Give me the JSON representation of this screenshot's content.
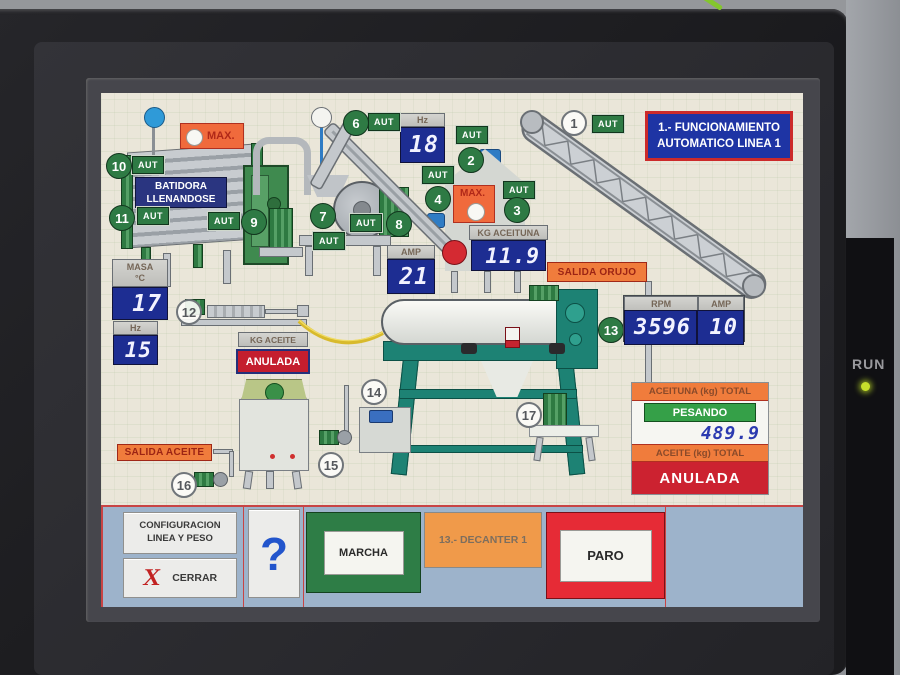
{
  "device": {
    "run_label": "RUN"
  },
  "title": {
    "line1": "1.- FUNCIONAMIENTO",
    "line2": "AUTOMATICO LINEA 1"
  },
  "aut_label": "AUT",
  "labels": {
    "max": "MAX.",
    "batidora_line1": "BATIDORA",
    "batidora_line2": "LLENANDOSE",
    "salida_orujo": "SALIDA ORUJO",
    "salida_aceite": "SALIDA ACEITE",
    "kg_aceite": "KG ACEITE",
    "kg_aceite_status": "ANULADA"
  },
  "badges": {
    "b1": "1",
    "b2": "2",
    "b3": "3",
    "b4": "4",
    "b6": "6",
    "b7": "7",
    "b8": "8",
    "b9": "9",
    "b10": "10",
    "b11": "11",
    "b12": "12",
    "b13": "13",
    "b14": "14",
    "b15": "15",
    "b16": "16",
    "b17": "17"
  },
  "displays": {
    "hz6": {
      "h": "Hz",
      "v": "18"
    },
    "amp8": {
      "h": "AMP",
      "v": "21"
    },
    "kg_aceituna": {
      "h": "KG ACEITUNA",
      "v": "11.9"
    },
    "masa": {
      "h1": "MASA",
      "h2": "°C",
      "v": "17"
    },
    "hz12": {
      "h": "Hz",
      "v": "15"
    },
    "rpm13": {
      "h": "RPM",
      "v": "3596"
    },
    "amp13": {
      "h": "AMP",
      "v": "10"
    }
  },
  "totals": {
    "aceituna_header": "ACEITUNA (kg) TOTAL",
    "status": "PESANDO",
    "value": "489.9",
    "aceite_header": "ACEITE (kg) TOTAL",
    "aceite_status": "ANULADA"
  },
  "footer": {
    "config_line1": "CONFIGURACION",
    "config_line2": "LINEA Y PESO",
    "close_x": "X",
    "close_label": "CERRAR",
    "help": "?",
    "marcha": "MARCHA",
    "decanter": "13.- DECANTER 1",
    "paro": "PARO"
  },
  "colors": {
    "accent_green": "#2e7a44",
    "display_blue": "#1d2d92",
    "alarm_red": "#cc2230",
    "warn_orange": "#f07c3c",
    "title_blue": "#1e34a4",
    "footer_blue": "#9db3cb"
  }
}
